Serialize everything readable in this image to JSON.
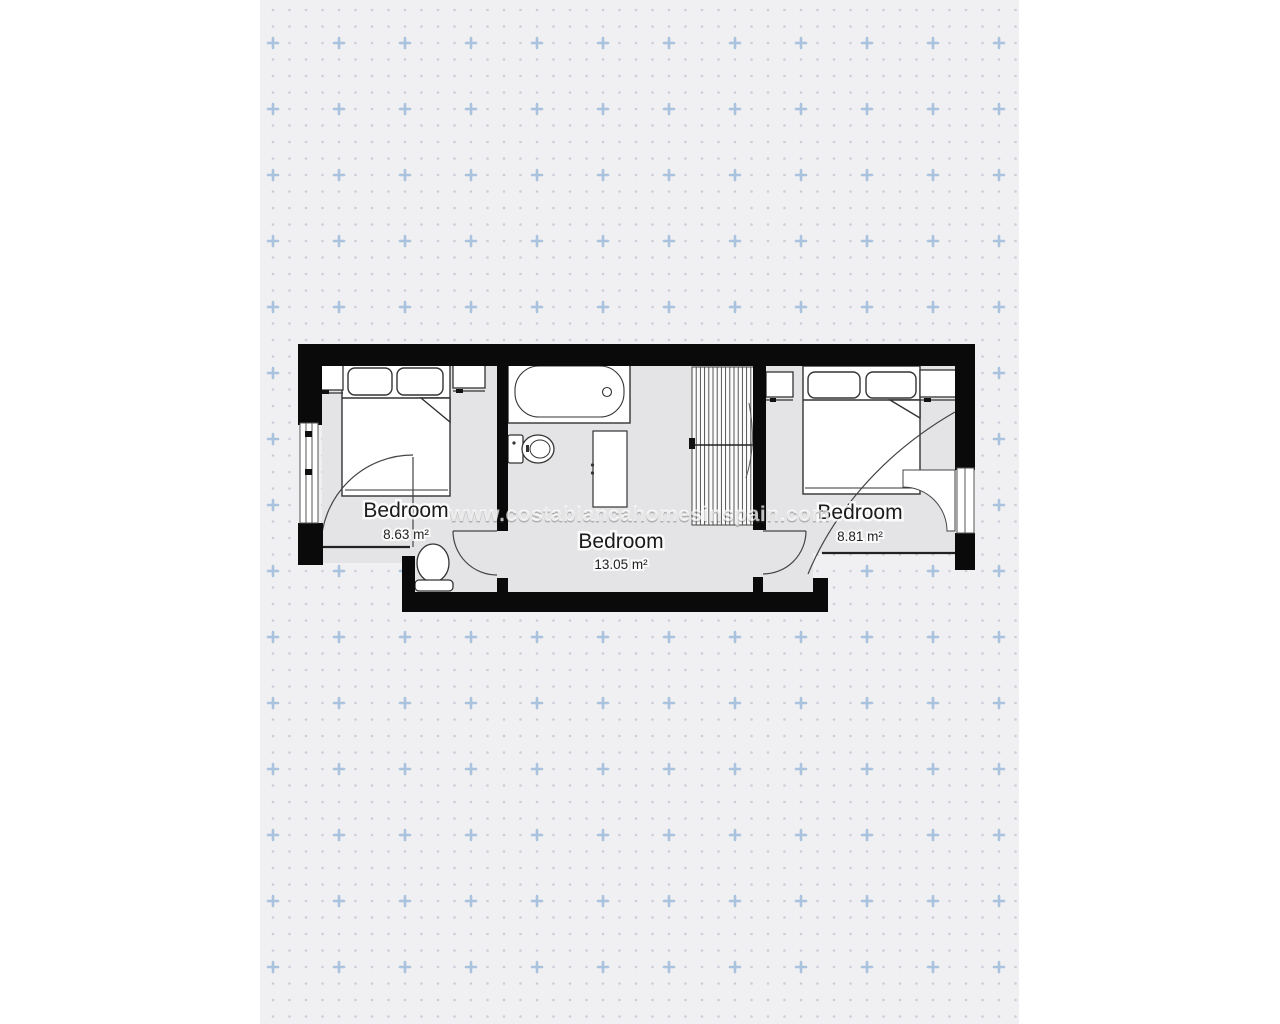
{
  "page": {
    "background_color": "#ffffff",
    "panel_background_color": "#f0f0f2",
    "dot_color": "#c9ced8",
    "plus_color": "#a9c2de"
  },
  "floorplan": {
    "wall_color": "#0a0a0a",
    "floor_color": "#e4e4e6",
    "furniture_stroke_color": "#333333",
    "rooms": [
      {
        "label": "Bedroom",
        "area": "8.63 m²"
      },
      {
        "label": "Bedroom",
        "area": "13.05 m²"
      },
      {
        "label": "Bedroom",
        "area": "8.81 m²"
      }
    ],
    "watermark": "www.costablancahomesinspain.com"
  }
}
